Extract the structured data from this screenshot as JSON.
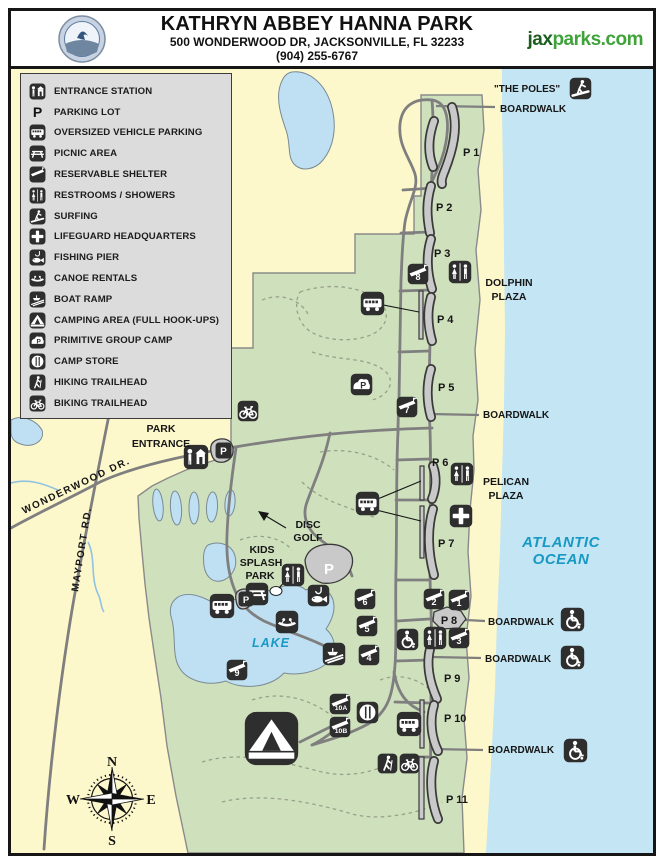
{
  "header": {
    "title": "KATHRYN ABBEY HANNA PARK",
    "address": "500 WONDERWOOD DR, JACKSONVILLE, FL 32233",
    "phone": "(904) 255-6767",
    "website_prefix": "jax",
    "website_suffix": "parks.com"
  },
  "legend": {
    "parking_letter": "P",
    "items": [
      {
        "icon": "entrance-station-icon",
        "label": "ENTRANCE STATION"
      },
      {
        "icon": "parking-lot-icon",
        "label": "PARKING LOT"
      },
      {
        "icon": "oversized-vehicle-parking-icon",
        "label": "OVERSIZED VEHICLE PARKING"
      },
      {
        "icon": "picnic-area-icon",
        "label": "PICNIC AREA"
      },
      {
        "icon": "reservable-shelter-icon",
        "label": "RESERVABLE SHELTER"
      },
      {
        "icon": "restrooms-showers-icon",
        "label": "RESTROOMS / SHOWERS"
      },
      {
        "icon": "surfing-icon",
        "label": "SURFING"
      },
      {
        "icon": "lifeguard-headquarters-icon",
        "label": "LIFEGUARD HEADQUARTERS"
      },
      {
        "icon": "fishing-pier-icon",
        "label": "FISHING PIER"
      },
      {
        "icon": "canoe-rentals-icon",
        "label": "CANOE RENTALS"
      },
      {
        "icon": "boat-ramp-icon",
        "label": "BOAT RAMP"
      },
      {
        "icon": "camping-area-icon",
        "label": "CAMPING AREA (FULL HOOK-UPS)"
      },
      {
        "icon": "primitive-group-camp-icon",
        "label": "PRIMITIVE GROUP CAMP"
      },
      {
        "icon": "camp-store-icon",
        "label": "CAMP STORE"
      },
      {
        "icon": "hiking-trailhead-icon",
        "label": "HIKING TRAILHEAD"
      },
      {
        "icon": "biking-trailhead-icon",
        "label": "BIKING TRAILHEAD"
      }
    ]
  },
  "map": {
    "labels": {
      "the_poles": "\"THE POLES\"",
      "boardwalk_top": "BOARDWALK",
      "boardwalk_mid": "BOARDWALK",
      "boardwalk_p8": "BOARDWALK",
      "boardwalk_p9": "BOARDWALK",
      "boardwalk_south": "BOARDWALK",
      "dolphin_line1": "DOLPHIN",
      "dolphin_line2": "PLAZA",
      "pelican_line1": "PELICAN",
      "pelican_line2": "PLAZA",
      "ocean_line1": "ATLANTIC",
      "ocean_line2": "OCEAN",
      "lake": "LAKE",
      "park_entrance_line1": "PARK",
      "park_entrance_line2": "ENTRANCE",
      "kids_line1": "KIDS",
      "kids_line2": "SPLASH",
      "kids_line3": "PARK",
      "disc_line1": "DISC",
      "disc_line2": "GOLF",
      "wonderwood": "WONDERWOOD DR.",
      "mayport": "MAYPORT RD."
    },
    "compass": {
      "north": "N",
      "east": "E",
      "south": "S",
      "west": "W"
    },
    "parking": {
      "letter": "P",
      "p1": "P 1",
      "p2": "P 2",
      "p3": "P 3",
      "p4": "P 4",
      "p5": "P 5",
      "p6": "P 6",
      "p7": "P 7",
      "p8": "P 8",
      "p9": "P 9",
      "p10": "P 10",
      "p11": "P 11"
    },
    "shelters": {
      "s1": "1",
      "s2": "2",
      "s3": "3",
      "s4": "4",
      "s5": "5",
      "s6": "6",
      "s7": "7",
      "s8": "8",
      "s9": "9",
      "s10a": "10A",
      "s10b": "10B"
    }
  },
  "colors": {
    "ocean": "#c3e5f4",
    "sand": "#fdf8cc",
    "park_green": "#cfe0bd",
    "inland_water": "#bfe0f2",
    "road_gray": "#7f7f7f",
    "icon_bg": "#2e2e2e",
    "legend_bg": "#dcdcdc",
    "water_text": "#1899c4",
    "site_prefix_green": "#1b5e20",
    "site_suffix_green": "#3fa33a"
  }
}
